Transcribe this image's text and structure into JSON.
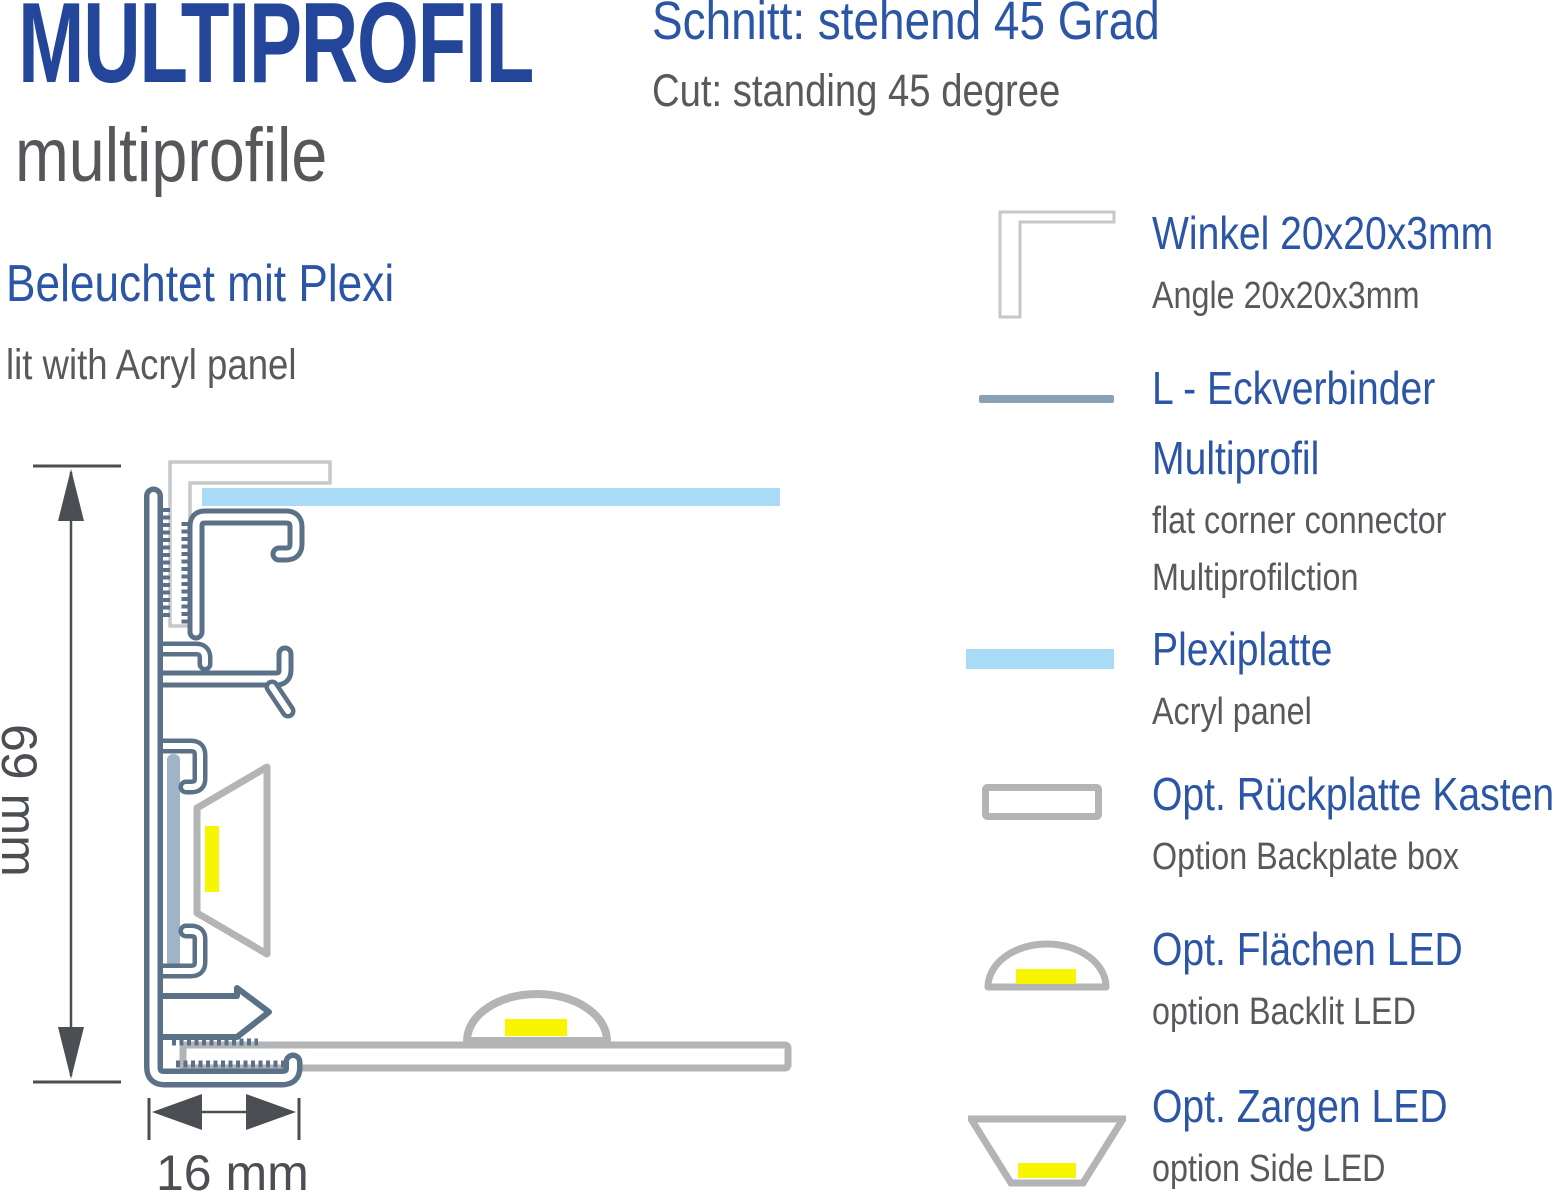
{
  "header": {
    "title": "MULTIPROFIL",
    "subtitle": "multiprofile",
    "cut_title_de": "Schnitt: stehend 45 Grad",
    "cut_title_en": "Cut: standing 45 degree"
  },
  "section": {
    "lit_de": "Beleuchtet mit Plexi",
    "lit_en": "lit with Acryl panel"
  },
  "diagram": {
    "height_label": "69 mm",
    "width_label": "16 mm"
  },
  "legend": {
    "items": [
      {
        "icon": "angle-bracket-icon",
        "title_de": "Winkel 20x20x3mm",
        "title_de2": "",
        "sub_en": "Angle 20x20x3mm",
        "sub_en2": ""
      },
      {
        "icon": "flat-connector-line-icon",
        "title_de": "L - Eckverbinder",
        "title_de2": "Multiprofil",
        "sub_en": "flat corner connector",
        "sub_en2": "Multiprofilction"
      },
      {
        "icon": "acryl-panel-icon",
        "title_de": "Plexiplatte",
        "title_de2": "",
        "sub_en": "Acryl panel",
        "sub_en2": ""
      },
      {
        "icon": "backplate-box-icon",
        "title_de": "Opt. Rückplatte Kasten",
        "title_de2": "",
        "sub_en": "Option Backplate box",
        "sub_en2": ""
      },
      {
        "icon": "backlit-led-icon",
        "title_de": "Opt. Flächen LED",
        "title_de2": "",
        "sub_en": "option Backlit LED",
        "sub_en2": ""
      },
      {
        "icon": "side-led-icon",
        "title_de": "Opt. Zargen LED",
        "title_de2": "",
        "sub_en": "option Side LED",
        "sub_en2": ""
      }
    ]
  },
  "colors": {
    "title_blue": "#24469a",
    "heading_blue": "#2b55a5",
    "text_gray": "#58595c",
    "dim_gray": "#4b4e52",
    "profile_slate": "#5b7187",
    "plexi_blue": "#a9dbf7",
    "led_yellow": "#f8f500",
    "light_gray": "#b2b4b6",
    "winkel_gray": "#c6c8ca",
    "strip_blue": "#9fb4c7",
    "connector_blue_gray": "#8ba2b6"
  }
}
